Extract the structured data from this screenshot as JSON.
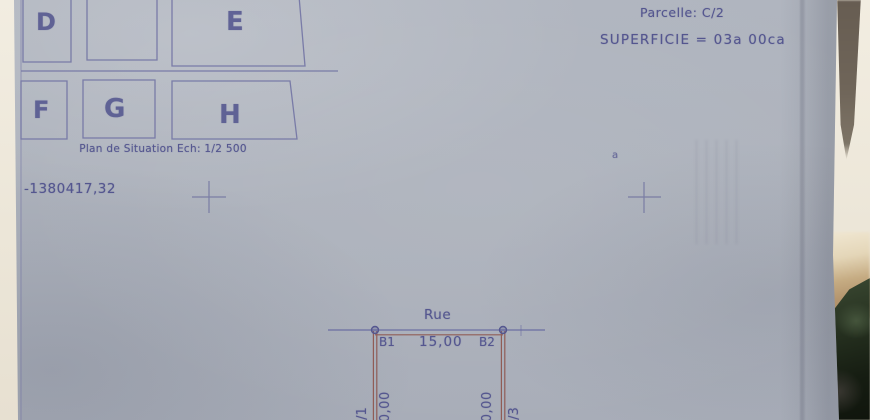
{
  "situation_plan": {
    "caption": "Plan de Situation Ech: 1/2 500",
    "cells": {
      "d": "D",
      "e": "E",
      "f": "F",
      "g": "G",
      "h": "H"
    }
  },
  "parcel_info": {
    "parcelle": "Parcelle: C/2",
    "superficie": "SUPERFICIE = 03a 00ca",
    "annotation": "a"
  },
  "coordinate": {
    "value": "-1380417,32"
  },
  "plot_plan": {
    "street": "Rue",
    "corner_left": "B1",
    "corner_right": "B2",
    "front_width": "15,00",
    "depth_left": "20,00",
    "depth_right": "20,00",
    "neighbor_left": "C/1",
    "neighbor_right": "C/3"
  },
  "colors": {
    "ink_blue": "#54568f",
    "ink_red": "#8e564e",
    "paper": "#adb2bc",
    "photo_background": "#efe9dc",
    "foliage": "#1f2b1a"
  }
}
